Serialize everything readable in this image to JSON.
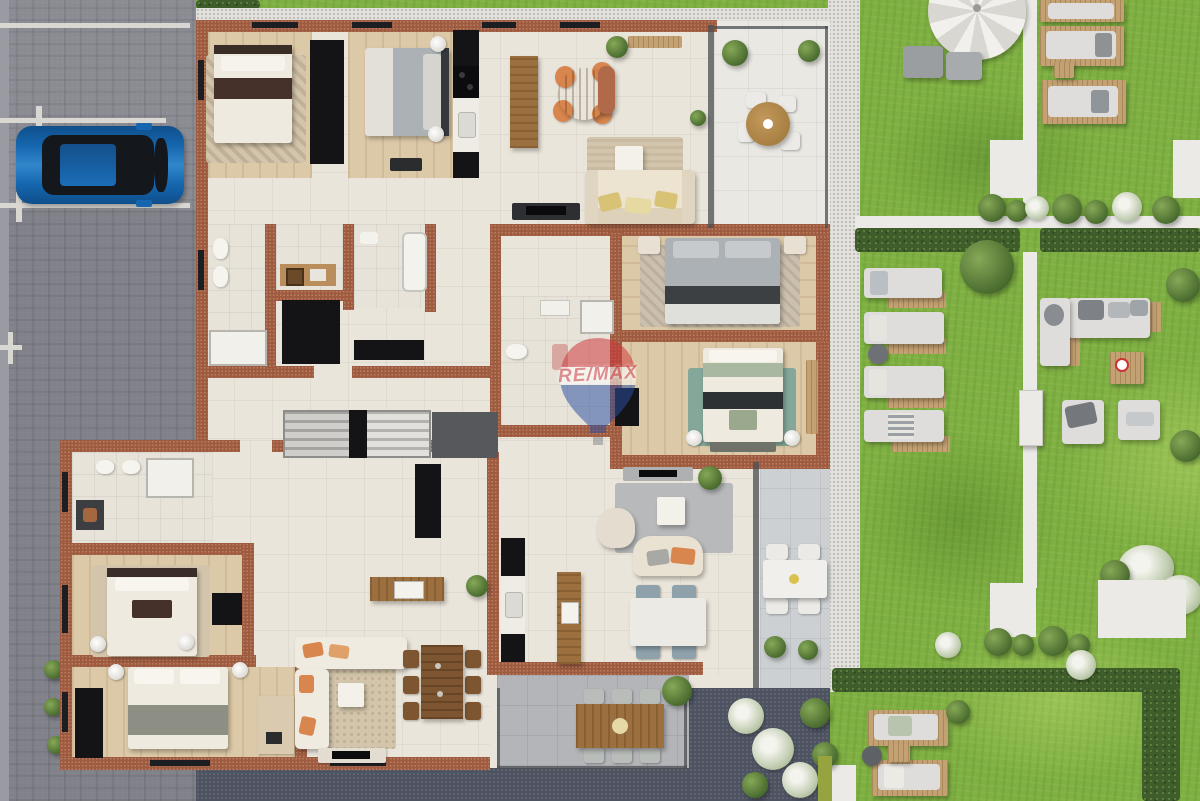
{
  "watermark": {
    "text": "RE/MAX"
  },
  "palette": {
    "paving": "#8b8b93",
    "pavingLight": "#9a9aa2",
    "lineWhite": "#d8d7d2",
    "carBlue": "#1566ae",
    "carBlueHi": "#3187cb",
    "carGlass": "#14171c",
    "wall": "#9e5b40",
    "wallSpeck": "#b97f63",
    "floorCream": "#eae5da",
    "floorWood": "#dcc9a8",
    "tileBath": "#e7e3d9",
    "terraceWhite": "#e9e8e3",
    "terraceGray": "#cdd0d2",
    "terraceSlate": "#b4b5b9",
    "gravelWhite": "#e2e1dc",
    "gravelDot": "#b4b3ae",
    "gravelDark": "#4d5361",
    "lawn": "#7fb043",
    "hedge": "#3f5d2b",
    "bushDark": "#46682c",
    "pathWhite": "#ebeae6",
    "deckWood": "#c3a173",
    "woodMid": "#9c6f3e",
    "woodDark": "#7d5531",
    "black": "#141417",
    "charcoal": "#3a3d41",
    "bedWhite": "#efeae0",
    "bedGray": "#abb1b5",
    "runnerBrown": "#46302a",
    "sofaCream": "#ece3d1",
    "pillowYellow": "#d8c276",
    "pillowOrange": "#d8854e",
    "rugTeal": "#84a79a",
    "rugGray": "#b7b9bb",
    "rugBeige": "#d2c5ab",
    "cushionWhite": "#dedddb",
    "chairSlate": "#8fa2ac",
    "glassDark": "#4a4e52",
    "white": "#f2f1ee",
    "remaxRed": "#c9353b",
    "remaxBlue": "#2b4ea2"
  }
}
